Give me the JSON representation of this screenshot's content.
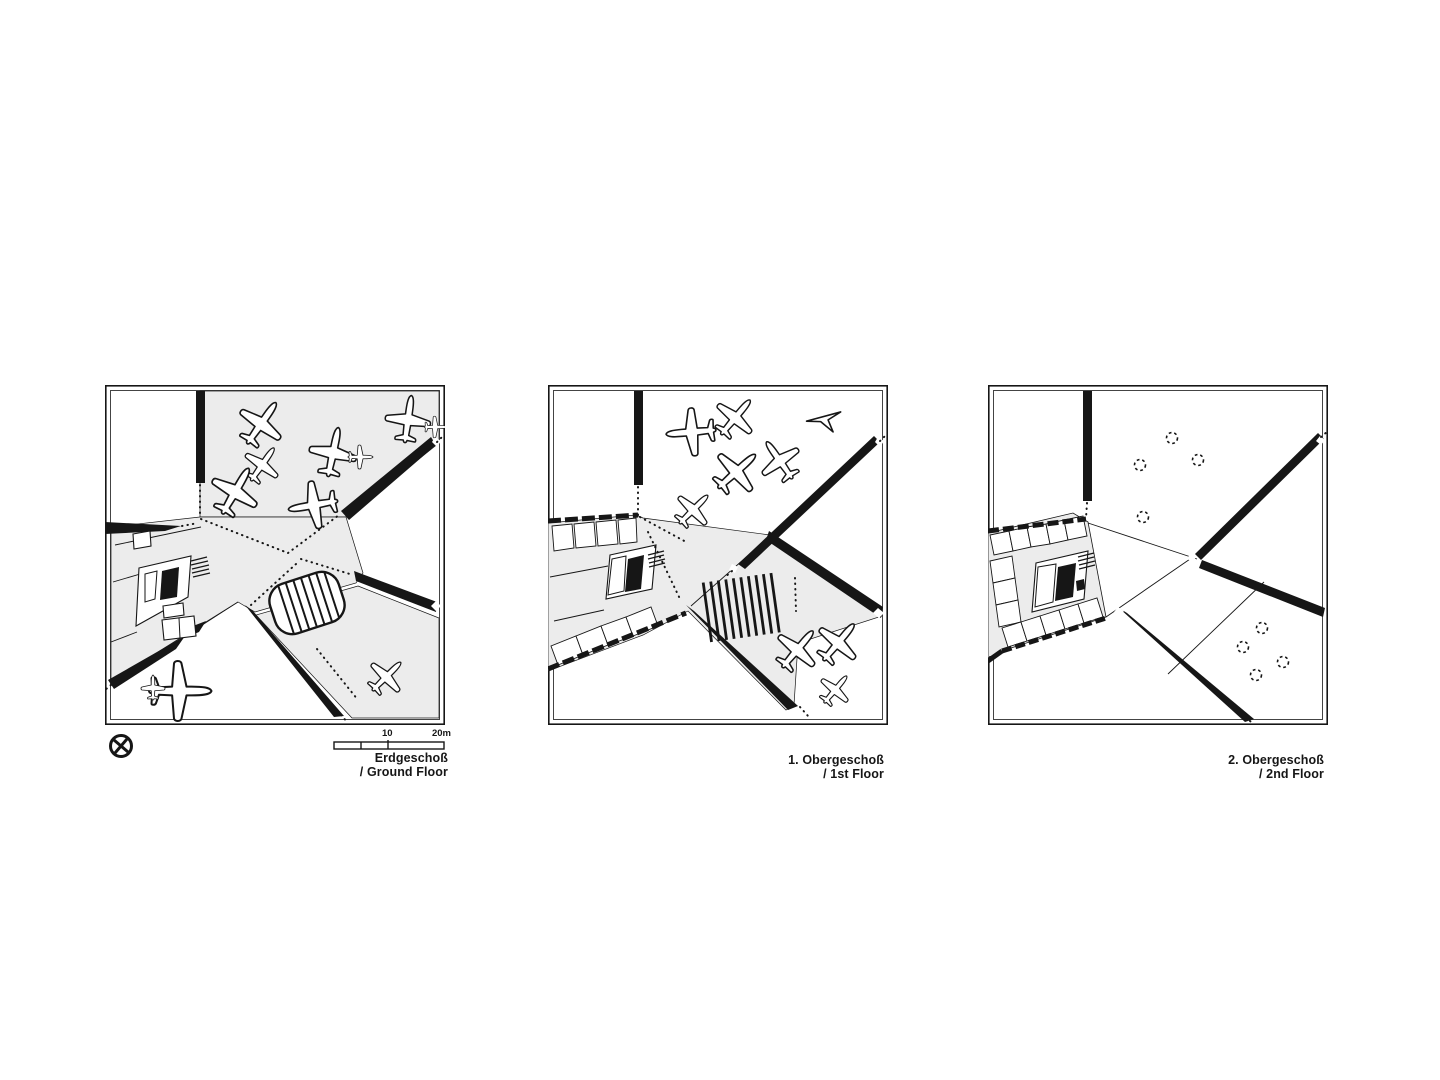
{
  "document": {
    "kind": "architectural-floor-plan-sheet"
  },
  "colors": {
    "ink": "#161616",
    "floor_fill": "#ececec",
    "paper": "#ffffff"
  },
  "plans": [
    {
      "name": "ground-floor",
      "caption_de": "Erdgeschoß",
      "caption_en": "/ Ground Floor"
    },
    {
      "name": "first-floor",
      "caption_de": "1. Obergeschoß",
      "caption_en": "/ 1st Floor"
    },
    {
      "name": "second-floor",
      "caption_de": "2. Obergeschoß",
      "caption_en": "/ 2nd Floor"
    }
  ],
  "scale_bar": {
    "mid_label": "10",
    "end_label": "20m"
  },
  "icons": {
    "north": "north-indicator",
    "airplane": "airplane-silhouette",
    "delta": "delta-wing-silhouette"
  }
}
